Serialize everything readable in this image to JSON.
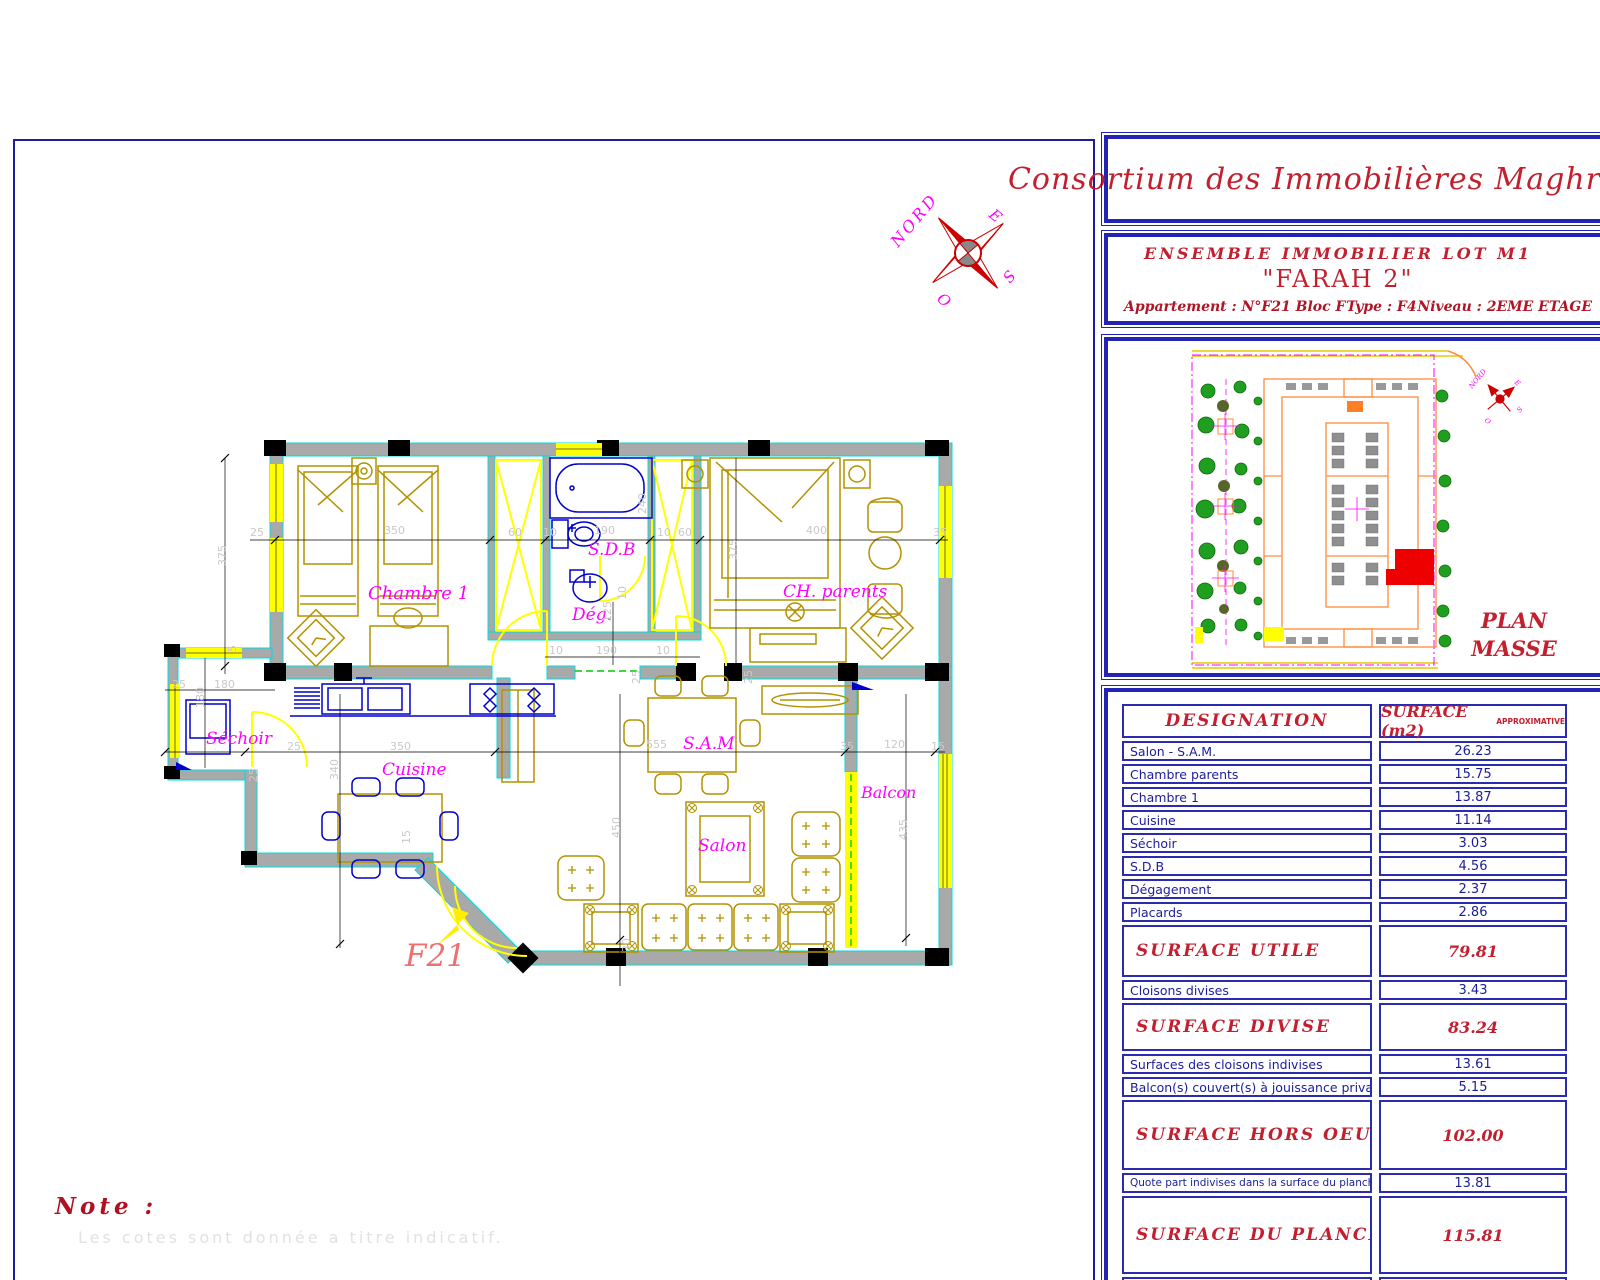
{
  "title_block": {
    "company": "Consortium des Immobilières Maghrébines",
    "project_line1": "ENSEMBLE   IMMOBILIER  LOT  M1",
    "project_line2": "\"FARAH 2\"",
    "apartment_label": "Appartement :",
    "apartment_value": "N°F21  Bloc F",
    "type_label": "Type :",
    "type_value": "F4",
    "niveau_label": "Niveau :",
    "niveau_value": "2EME ETAGE",
    "plan_masse_line1": "PLAN",
    "plan_masse_line2": "MASSE"
  },
  "surface_table": {
    "header_left": "DESIGNATION",
    "header_right": "SURFACE (m2)",
    "header_right_small": "APPROXIMATIVE",
    "rows": [
      {
        "label": "Salon - S.A.M.",
        "value": "26.23",
        "kind": "item"
      },
      {
        "label": "Chambre parents",
        "value": "15.75",
        "kind": "item"
      },
      {
        "label": "Chambre 1",
        "value": "13.87",
        "kind": "item"
      },
      {
        "label": "Cuisine",
        "value": "11.14",
        "kind": "item"
      },
      {
        "label": "Séchoir",
        "value": "3.03",
        "kind": "item"
      },
      {
        "label": "S.D.B",
        "value": "4.56",
        "kind": "item"
      },
      {
        "label": "Dégagement",
        "value": "2.37",
        "kind": "item"
      },
      {
        "label": "Placards",
        "value": "2.86",
        "kind": "item"
      },
      {
        "label": "SURFACE  UTILE",
        "value": "79.81",
        "kind": "total",
        "h": 52
      },
      {
        "label": "Cloisons divises",
        "value": "3.43",
        "kind": "item"
      },
      {
        "label": "SURFACE  DIVISE",
        "value": "83.24",
        "kind": "total",
        "h": 48
      },
      {
        "label": "Surfaces des cloisons indivises",
        "value": "13.61",
        "kind": "item"
      },
      {
        "label": "Balcon(s) couvert(s) à jouissance privative",
        "value": "5.15",
        "kind": "item"
      },
      {
        "label": "SURFACE  HORS  OEUVRE",
        "value": "102.00",
        "kind": "total",
        "h": 70
      },
      {
        "label": "Quote part indivises dans la surface du plancher",
        "value": "13.81",
        "kind": "small"
      },
      {
        "label": "SURFACE  DU  PLANCHER",
        "value": "115.81",
        "kind": "total",
        "h": 78
      },
      {
        "label": "Numéro de la place de parking",
        "value": "--",
        "kind": "parking",
        "h": 44
      }
    ]
  },
  "floor_plan": {
    "unit_label": "F21",
    "room_labels": [
      {
        "t": "Chambre 1",
        "x": 368,
        "y": 583,
        "s": 18
      },
      {
        "t": "S.D.B",
        "x": 588,
        "y": 540,
        "s": 17
      },
      {
        "t": "Dég.",
        "x": 572,
        "y": 605,
        "s": 17
      },
      {
        "t": "CH. parents",
        "x": 783,
        "y": 582,
        "s": 17
      },
      {
        "t": "Séchoir",
        "x": 206,
        "y": 729,
        "s": 17
      },
      {
        "t": "Cuisine",
        "x": 382,
        "y": 760,
        "s": 17
      },
      {
        "t": "S.A.M",
        "x": 683,
        "y": 734,
        "s": 17
      },
      {
        "t": "Salon",
        "x": 698,
        "y": 836,
        "s": 17
      },
      {
        "t": "Balcon",
        "x": 861,
        "y": 783,
        "s": 16
      }
    ],
    "dimensions": [
      {
        "t": "25",
        "x": 250,
        "y": 526
      },
      {
        "t": "350",
        "x": 384,
        "y": 524
      },
      {
        "t": "60",
        "x": 508,
        "y": 526
      },
      {
        "t": "10",
        "x": 543,
        "y": 526
      },
      {
        "t": "190",
        "x": 594,
        "y": 524
      },
      {
        "t": "240",
        "x": 636,
        "y": 514,
        "v": 1
      },
      {
        "t": "10",
        "x": 657,
        "y": 526
      },
      {
        "t": "60",
        "x": 678,
        "y": 526
      },
      {
        "t": "400",
        "x": 806,
        "y": 524
      },
      {
        "t": "35",
        "x": 933,
        "y": 526
      },
      {
        "t": "375",
        "x": 216,
        "y": 566,
        "v": 1
      },
      {
        "t": "375",
        "x": 727,
        "y": 560,
        "v": 1
      },
      {
        "t": "10",
        "x": 549,
        "y": 644
      },
      {
        "t": "190",
        "x": 596,
        "y": 644
      },
      {
        "t": "10",
        "x": 656,
        "y": 644
      },
      {
        "t": "125",
        "x": 601,
        "y": 622,
        "v": 1
      },
      {
        "t": "10",
        "x": 616,
        "y": 600,
        "v": 1
      },
      {
        "t": "25",
        "x": 172,
        "y": 678
      },
      {
        "t": "180",
        "x": 214,
        "y": 678
      },
      {
        "t": "180",
        "x": 194,
        "y": 708,
        "v": 1
      },
      {
        "t": "5",
        "x": 226,
        "y": 652,
        "v": 1
      },
      {
        "t": "25",
        "x": 287,
        "y": 740
      },
      {
        "t": "350",
        "x": 390,
        "y": 740
      },
      {
        "t": "555",
        "x": 646,
        "y": 738
      },
      {
        "t": "35",
        "x": 840,
        "y": 740
      },
      {
        "t": "120",
        "x": 884,
        "y": 738
      },
      {
        "t": "15",
        "x": 931,
        "y": 740
      },
      {
        "t": "340",
        "x": 328,
        "y": 780,
        "v": 1
      },
      {
        "t": "450",
        "x": 610,
        "y": 838,
        "v": 1
      },
      {
        "t": "435",
        "x": 897,
        "y": 840,
        "v": 1
      },
      {
        "t": "25",
        "x": 247,
        "y": 782,
        "v": 1
      },
      {
        "t": "25",
        "x": 630,
        "y": 684,
        "v": 1
      },
      {
        "t": "25",
        "x": 742,
        "y": 684,
        "v": 1
      },
      {
        "t": "30",
        "x": 620,
        "y": 952,
        "v": 1
      },
      {
        "t": "15",
        "x": 400,
        "y": 844,
        "v": 1
      }
    ]
  },
  "compass": {
    "north": "NORD",
    "east": "E",
    "west": "O",
    "south": "S"
  },
  "note": {
    "label": "Note :",
    "text": "Les cotes sont donnée a titre indicatif."
  }
}
